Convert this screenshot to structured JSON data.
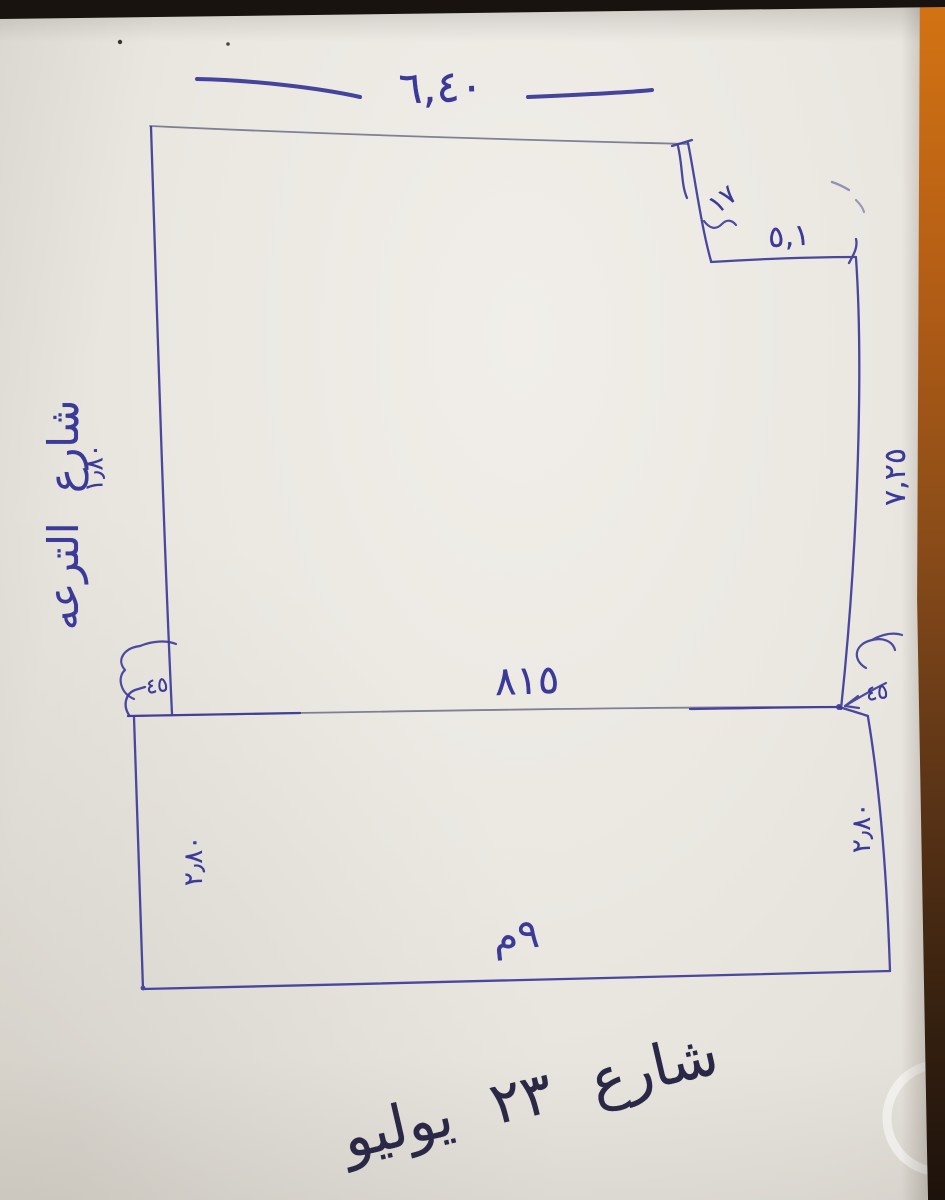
{
  "photo": {
    "description_labels_script": "Arabic",
    "colors": {
      "ink_blue": "#3c3a99",
      "ink_dark": "#2b2847",
      "paper": "#ebe8e2",
      "wood_edge": "#b65f15",
      "table_edge": "#18130e"
    }
  },
  "labels": {
    "top_width": "٦,٤٠",
    "notch_depth": "١٧",
    "notch_width": "٥,١",
    "right_side": "٧,٢٥",
    "middle_width": "٨١٥",
    "left_number": "١٫٨٠",
    "left_street": "شارع الترعه",
    "corner_left": "٤٥",
    "corner_right": "٤٥",
    "strip_left": "٢٫٨٠",
    "strip_right": "٢٫٨٠",
    "strip_bottom": "٩م",
    "bottom_street": "شارع ٢٣ يوليو"
  }
}
